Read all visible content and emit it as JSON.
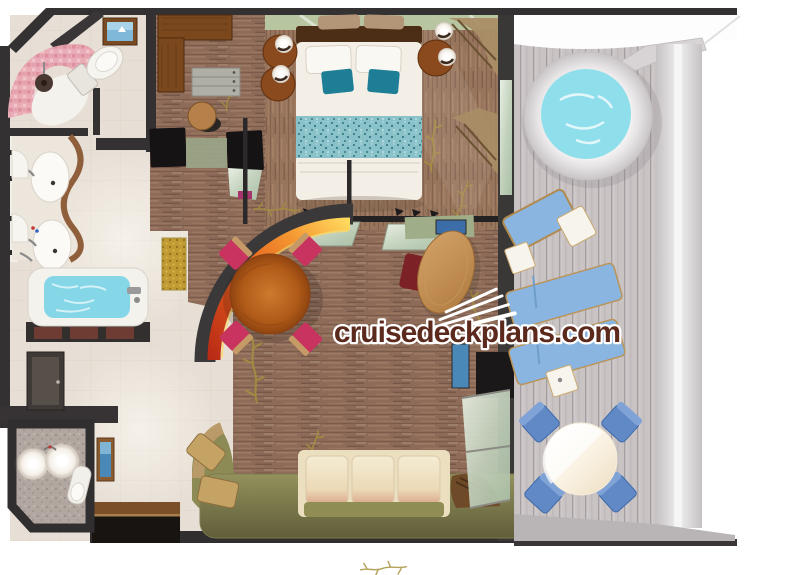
{
  "watermark": {
    "text": "cruisedeckplans.com",
    "logo": "cruise-ship-icon"
  },
  "floorplan": {
    "description": "Top-down 3D rendered cruise-ship suite floor plan with private balcony",
    "rooms": [
      {
        "name": "shower-room",
        "items": [
          "curved pink mosaic shower",
          "shower head",
          "toilet",
          "framed ocean picture"
        ]
      },
      {
        "name": "vanity-bathroom",
        "items": [
          "double vanity with two oval sinks",
          "wavy wood counter edge",
          "chrome faucets"
        ]
      },
      {
        "name": "bathtub-room",
        "items": [
          "bathtub with water",
          "tub faucet",
          "gold bath mat"
        ]
      },
      {
        "name": "powder-room",
        "items": [
          "two round glowing basins",
          "toilet",
          "speckled floor"
        ]
      },
      {
        "name": "entry-hall",
        "items": [
          "mirror panel",
          "framed blue picture",
          "sideboard cabinet"
        ]
      },
      {
        "name": "walk-in-closet",
        "items": [
          "L-shaped wood wardrobe",
          "dresser with drawers",
          "round stool",
          "two black luggage benches"
        ]
      },
      {
        "name": "bedroom",
        "items": [
          "double bed with teal runner",
          "white and teal pillows",
          "dark wood headboard",
          "two round nightstands with sphere lamps",
          "sage green wall",
          "tan curtains"
        ]
      },
      {
        "name": "living-dining-room",
        "items": [
          "round wood dining table",
          "four pink dining chairs",
          "curved red-orange art wall",
          "oval wood desk with red chair",
          "green shelf with picture",
          "cream sofa with olive cushions",
          "curved olive bench with gold cushions",
          "TV cabinet",
          "sliding glass doors"
        ]
      },
      {
        "name": "balcony",
        "items": [
          "round hot tub",
          "three blue loungers",
          "two white side tables",
          "round outdoor table",
          "four blue chairs",
          "plank deck",
          "railing"
        ]
      }
    ]
  },
  "colors": {
    "wall": "#343132",
    "floor_cream": "#e7dfd5",
    "closet_floor_wood": "#8d6b58",
    "bedroom_floor_wood": "#97745c",
    "vine_gold": "#a6923e",
    "shower_pink": "#e9abb5",
    "bathtub_water": "#85d7e8",
    "hot_tub_water": "#8edfeb",
    "teal_pillow": "#1e7e96",
    "bed_runner_teal": "#86c3cc",
    "headboard_wall_green": "#b7c6a0",
    "dining_table_wood": "#b4611f",
    "dining_chair_pink": "#c9335f",
    "art_red": "#c22f1a",
    "art_yellow": "#ffd95e",
    "sofa_cream": "#ecdfc0",
    "sofa_seat_olive": "#8f8d54",
    "bench_olive": "#7e7c4e",
    "desk_wood": "#c28f57",
    "curtain_tan": "#a98e66",
    "gold_mat": "#c19a33",
    "deck_gray": "#c8c2c3",
    "railing_gray": "#d8d4d5",
    "lounger_blue": "#8ab5e0",
    "balcony_chair_blue": "#6089c6",
    "balcony_table_cream": "#f6ecd9",
    "watermark": "#5c2a1d"
  }
}
